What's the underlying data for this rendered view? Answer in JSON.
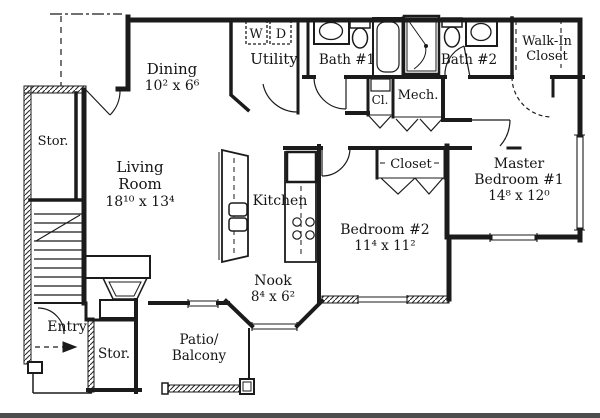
{
  "plan_title": "apartment-floor-plan",
  "colors": {
    "ink": "#1b1b1b",
    "paper": "#ffffff",
    "scan_bar": "#4d4d4d"
  },
  "rooms": {
    "dining": {
      "name": "Dining",
      "dims": "10² x 6⁶"
    },
    "utility": {
      "name": "Utility"
    },
    "washer": {
      "label": "W"
    },
    "dryer": {
      "label": "D"
    },
    "bath1": {
      "name": "Bath #1"
    },
    "bath2": {
      "name": "Bath #2"
    },
    "walkin": {
      "line1": "Walk-In",
      "line2": "Closet"
    },
    "cl": {
      "name": "Cl."
    },
    "mech": {
      "name": "Mech."
    },
    "living": {
      "line1": "Living",
      "line2": "Room",
      "dims": "18¹⁰ x 13⁴"
    },
    "kitchen": {
      "name": "Kitchen"
    },
    "nook": {
      "name": "Nook",
      "dims": "8⁴ x 6²"
    },
    "master": {
      "line1": "Master",
      "line2": "Bedroom #1",
      "dims": "14⁸ x 12⁰"
    },
    "bedroom2": {
      "name": "Bedroom #2",
      "dims": "11⁴ x 11²"
    },
    "closet": {
      "name": "Closet"
    },
    "stor_upper": {
      "name": "Stor."
    },
    "stor_lower": {
      "name": "Stor."
    },
    "entry": {
      "name": "Entry"
    },
    "patio": {
      "line1": "Patio/",
      "line2": "Balcony"
    }
  }
}
